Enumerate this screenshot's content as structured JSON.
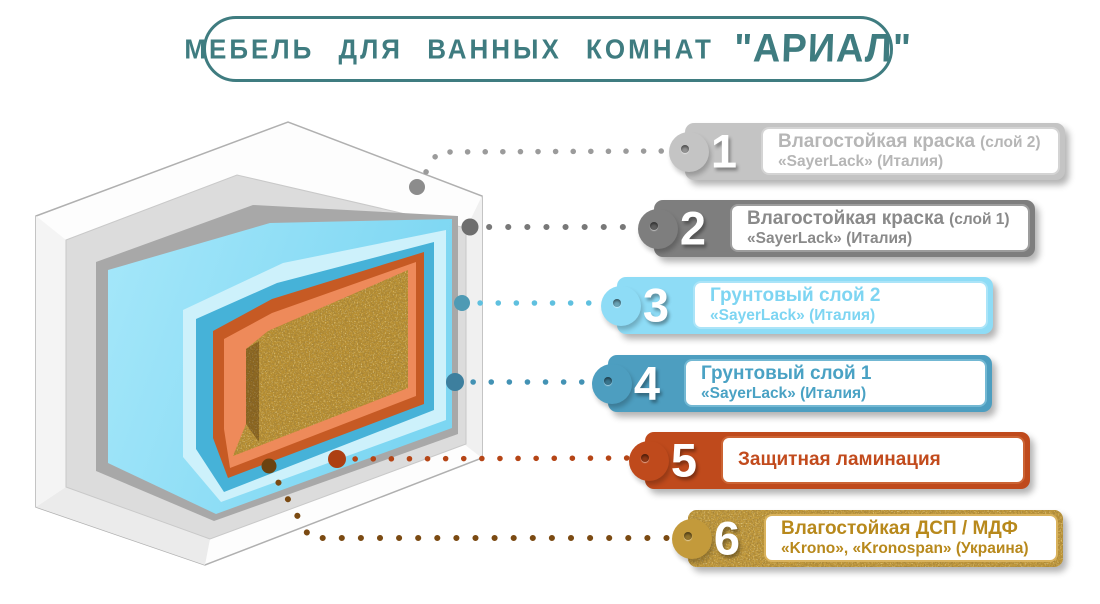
{
  "accent": "#3f7c80",
  "page_bg": "#ffffff",
  "title": {
    "main": "МЕБЕЛЬ ДЛЯ ВАННЫХ КОМНАТ",
    "brand": "\"АРИАЛ\""
  },
  "labels": [
    {
      "num": "1",
      "title": "Влагостойкая краска",
      "suffix": "(слой 2)",
      "subtitle": "«SayerLack» (Италия)",
      "tab_color": "#c4c4c4",
      "text_color": "#b6b6b6",
      "panel_border": "#d4d4d4",
      "line_color": "#9b9b9b"
    },
    {
      "num": "2",
      "title": "Влагостойкая краска",
      "suffix": "(слой 1)",
      "subtitle": "«SayerLack» (Италия)",
      "tab_color": "#7e7e7e",
      "text_color": "#8a8a8a",
      "panel_border": "#9d9d9d",
      "line_color": "#787878"
    },
    {
      "num": "3",
      "title": "Грунтовый слой 2",
      "suffix": "",
      "subtitle": "«SayerLack» (Италия)",
      "tab_color": "#8edcf6",
      "text_color": "#7ed5f2",
      "panel_border": "#abe4f8",
      "line_color": "#5fc0df"
    },
    {
      "num": "4",
      "title": "Грунтовый слой 1",
      "suffix": "",
      "subtitle": "«SayerLack» (Италия)",
      "tab_color": "#4d9ec0",
      "text_color": "#4aa2c4",
      "panel_border": "#73b8d3",
      "line_color": "#4392b4"
    },
    {
      "num": "5",
      "title": "Защитная ламинация",
      "suffix": "",
      "subtitle": "",
      "tab_color": "#bf4a1c",
      "text_color": "#c24b1d",
      "panel_border": "#cc6434",
      "line_color": "#b54516"
    },
    {
      "num": "6",
      "title": "Влагостойкая ДСП / МДФ",
      "suffix": "",
      "subtitle": "«Krono», «Kronospan» (Украина)",
      "tab_color": "#c39a3b",
      "text_color": "#b8891c",
      "panel_border": "#d9b25c",
      "line_color": "#7b4a12"
    }
  ],
  "diagram": {
    "layers": [
      {
        "name": "Влагостойкая краска (слой 2)",
        "color": "#fdfdfd"
      },
      {
        "name": "Влагостойкая краска (слой 1)",
        "color": "#dcdcdc"
      },
      {
        "name": "Грунтовый слой 2",
        "color": "#8ee1f8"
      },
      {
        "name": "Грунтовый слой 1",
        "color": "#46b2d8"
      },
      {
        "name": "Защитная ламинация",
        "color": "#ee8a5a"
      },
      {
        "name": "Влагостойкая ДСП / МДФ",
        "color": "#bb9132"
      }
    ]
  }
}
